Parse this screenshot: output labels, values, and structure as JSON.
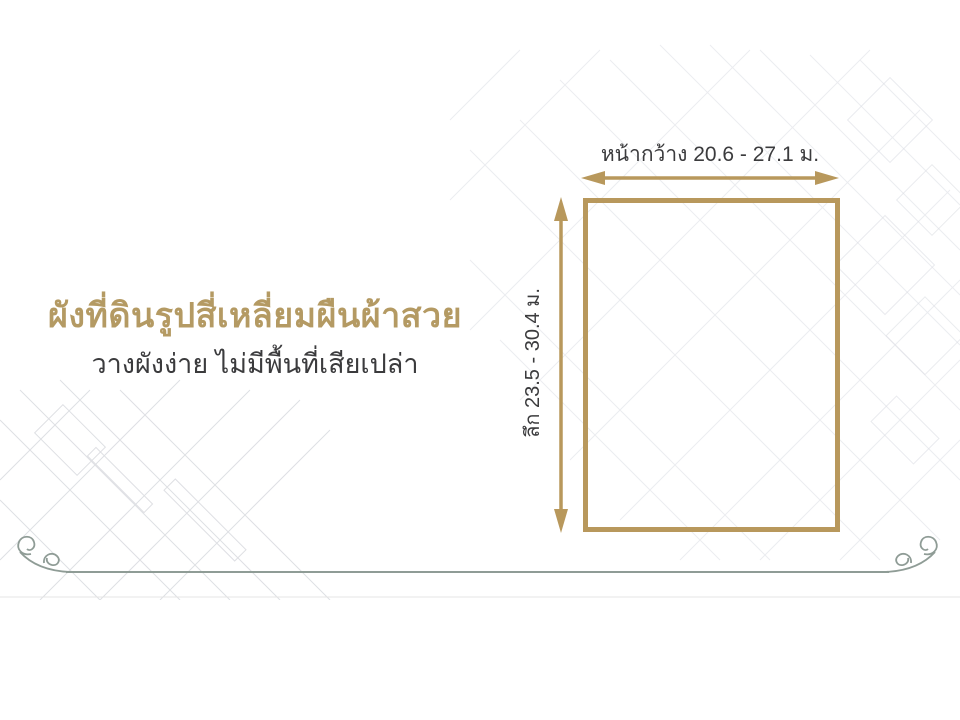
{
  "slide": {
    "title": "ผังที่ดินรูปสี่เหลี่ยมผืนผ้าสวย",
    "subtitle": "วางผังง่าย ไม่มีพื้นที่เสียเปล่า"
  },
  "diagram": {
    "width_label": "หน้ากว้าง 20.6 - 27.1 ม.",
    "depth_label": "ลึก 23.5 - 30.4 ม."
  },
  "colors": {
    "gold": "#b8985c",
    "gold-title": "#b49a63",
    "dark-text": "#3b3b3d",
    "divider": "#8f9c96",
    "blueprint-line": "#dcdee4",
    "background": "#ffffff"
  }
}
